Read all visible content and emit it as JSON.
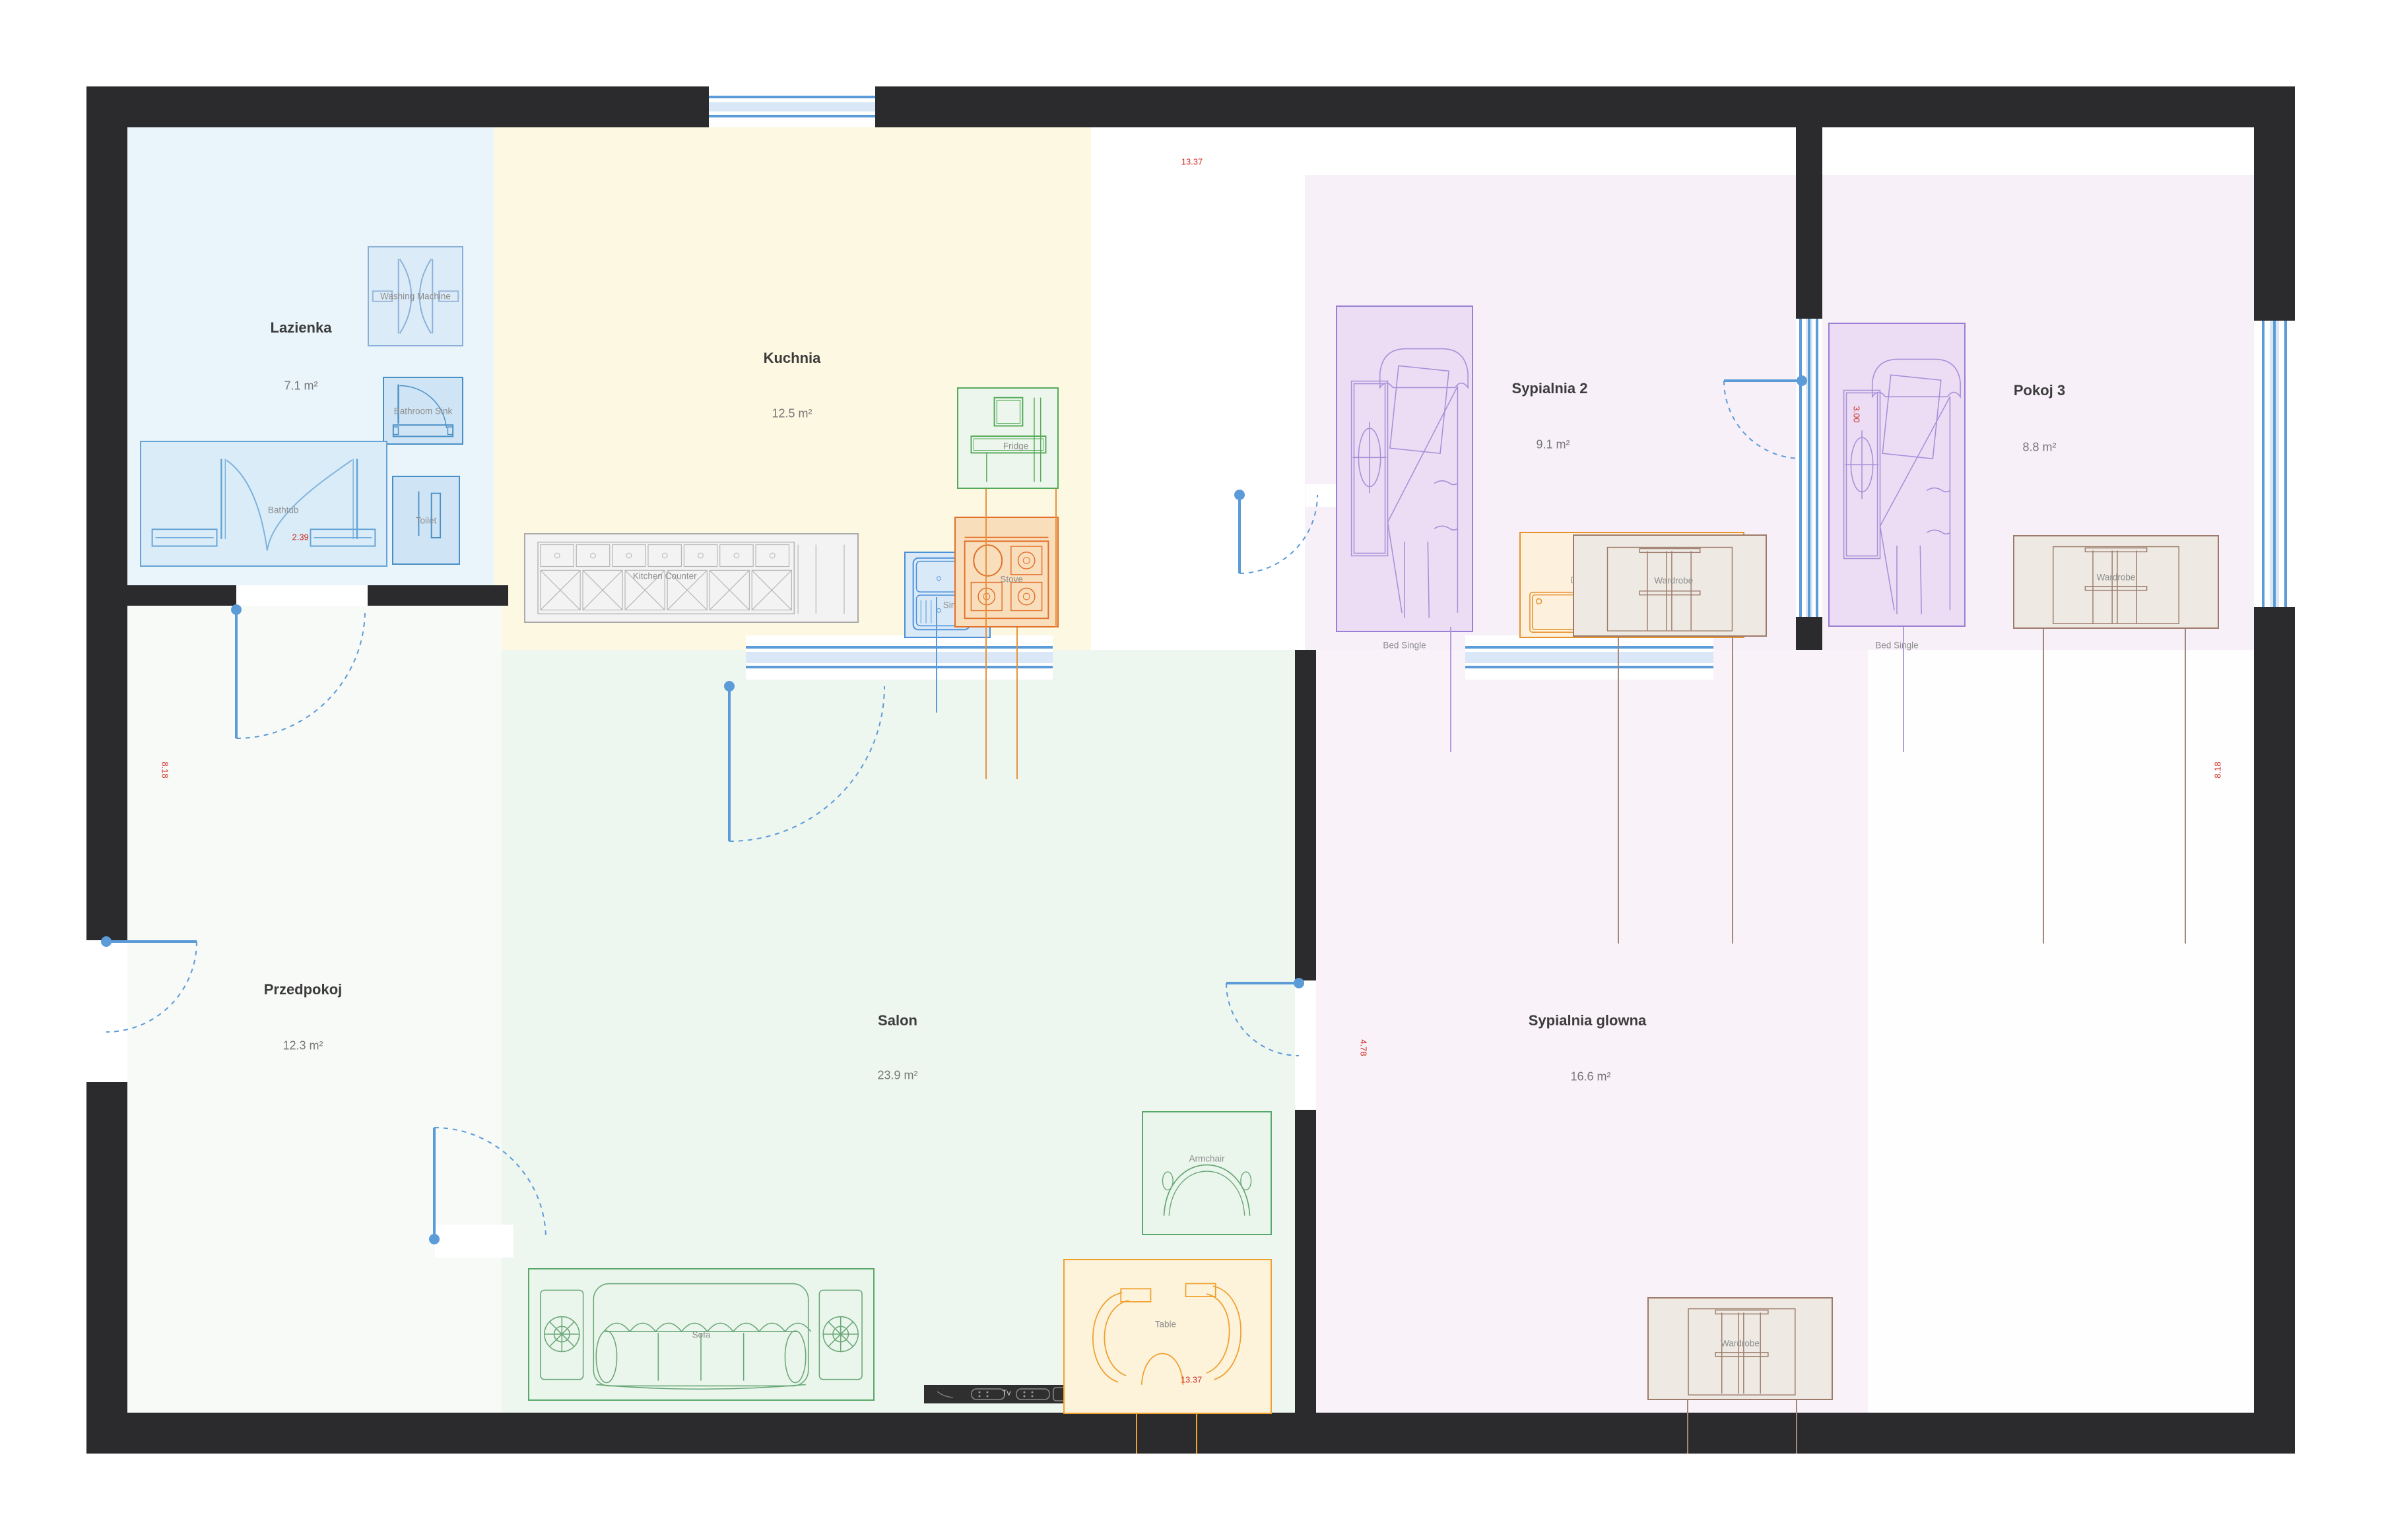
{
  "plan": {
    "rooms": {
      "lazienka": {
        "name": "Lazienka",
        "area": "7.1 m²"
      },
      "kuchnia": {
        "name": "Kuchnia",
        "area": "12.5 m²"
      },
      "przedpokoj": {
        "name": "Przedpokoj",
        "area": "12.3 m²"
      },
      "salon": {
        "name": "Salon",
        "area": "23.9 m²"
      },
      "sypialnia2": {
        "name": "Sypialnia 2",
        "area": "9.1 m²"
      },
      "pokoj3": {
        "name": "Pokoj 3",
        "area": "8.8 m²"
      },
      "sypialnia_glowna": {
        "name": "Sypialnia glowna",
        "area": "16.6 m²"
      }
    },
    "furniture": {
      "washing_machine": "Washing Machine",
      "bathroom_sink": "Bathroom Sink",
      "bathtub": "Bathtub",
      "toilet": "Toilet",
      "kitchen_counter": "Kitchen Counter",
      "fridge": "Fridge",
      "sink": "Sink",
      "stove": "Stove",
      "sofa": "Sofa",
      "tv": "Tv",
      "armchair": "Armchair",
      "table": "Table",
      "bed_single": "Bed Single",
      "desk": "Desk",
      "wardrobe": "Wardrobe"
    },
    "dimensions": {
      "top_width": "13.37",
      "bottom_width": "13.37",
      "left_height": "8.18",
      "right_height": "8.18",
      "bathtub_width": "2.39",
      "salon_wall": "4.78",
      "bed3_length": "3.00"
    },
    "colors": {
      "wall": "#2b2b2d",
      "opening_blue": "#5b9bd8",
      "dimension_red": "#cf2b24",
      "room_lazienka": "#e9f4fb",
      "room_kuchnia": "#fdf8e1",
      "room_salon": "#eef6f0",
      "room_przedpokoj": "#f8faf8",
      "room_sypialnia": "#f7f0f8",
      "room_sypialnia_glowna": "#f9f2f8"
    }
  }
}
